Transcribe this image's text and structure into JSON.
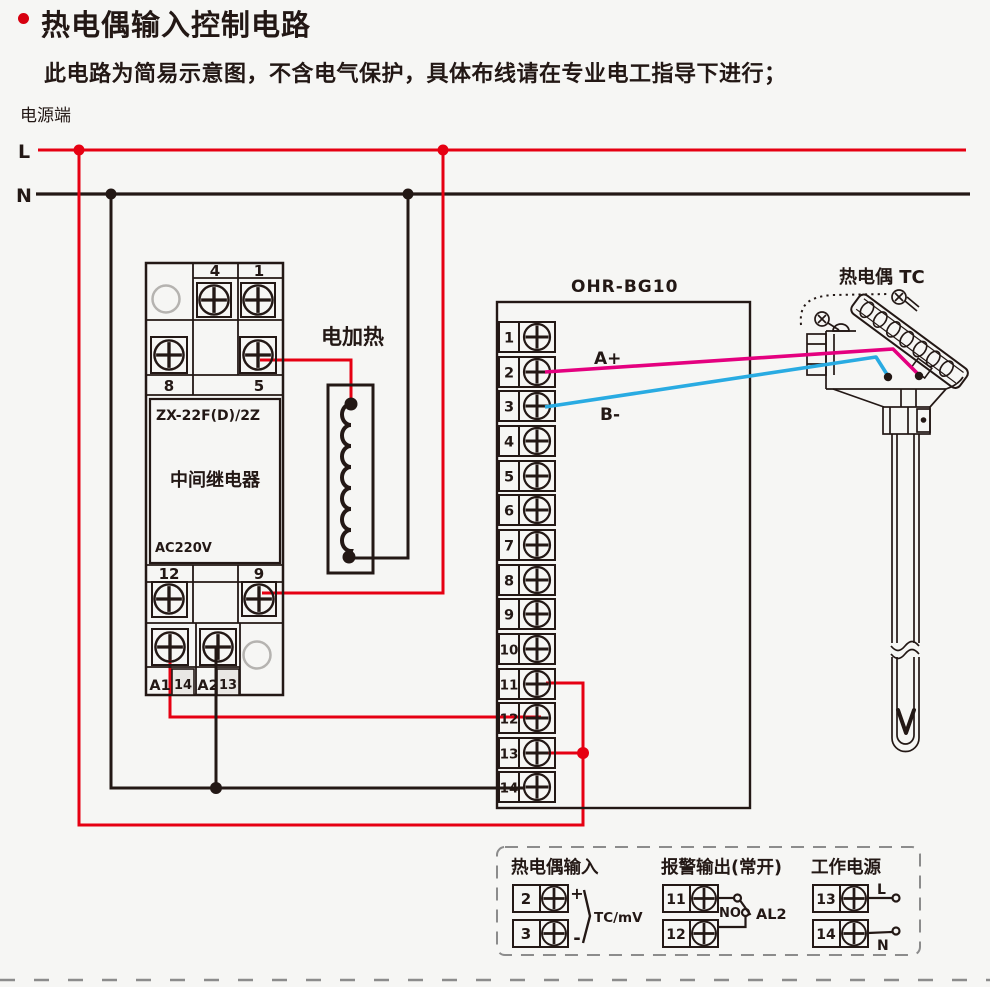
{
  "page": {
    "title": "热电偶输入控制电路",
    "subtitle": "此电路为简易示意图，不含电气保护，具体布线请在专业电工指导下进行；",
    "power_side_label": "电源端",
    "line_l": "L",
    "line_n": "N"
  },
  "relay": {
    "model": "ZX-22F(D)/2Z",
    "name": "中间继电器",
    "voltage": "AC220V",
    "terminals": {
      "t4": "4",
      "t1": "1",
      "t8": "8",
      "t5": "5",
      "t12": "12",
      "t9": "9",
      "a1": "A1",
      "n14": "14",
      "a2": "A2",
      "n13": "13"
    }
  },
  "heater": {
    "label": "电加热"
  },
  "controller": {
    "model": "OHR-BG10",
    "terminals": [
      "1",
      "2",
      "3",
      "4",
      "5",
      "6",
      "7",
      "8",
      "9",
      "10",
      "11",
      "12",
      "13",
      "14"
    ],
    "wire_a_label": "A+",
    "wire_b_label": "B-"
  },
  "thermocouple": {
    "label": "热电偶 TC"
  },
  "legend": {
    "input": {
      "title": "热电偶输入",
      "t2": "2",
      "t3": "3",
      "plus": "+",
      "minus": "-",
      "signal": "TC/mV"
    },
    "alarm": {
      "title": "报警输出(常开)",
      "t11": "11",
      "t12": "12",
      "contact": "NO",
      "output": "AL2"
    },
    "power": {
      "title": "工作电源",
      "t13": "13",
      "t14": "14",
      "l": "L",
      "n": "N"
    }
  },
  "colors": {
    "line_red": "#e60012",
    "wire_magenta": "#e4007f",
    "wire_blue": "#29abe2",
    "ink_black": "#231815"
  }
}
